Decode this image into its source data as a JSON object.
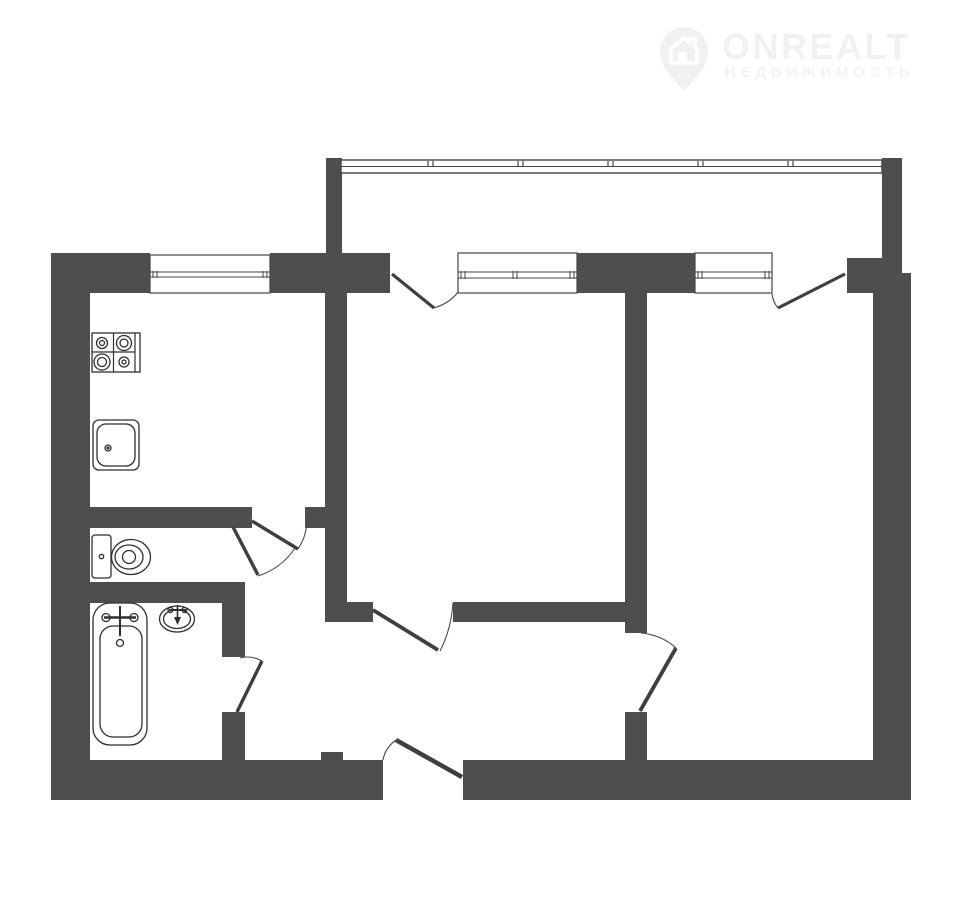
{
  "canvas": {
    "width": 960,
    "height": 910,
    "background": "#ffffff"
  },
  "watermark": {
    "brand": "ONREALT",
    "tagline": "НЕДВИЖИМОСТЬ",
    "color": "#f2f1f1",
    "tagline_color": "#f4f3f3",
    "icon": "house-pin"
  },
  "floorplan": {
    "colors": {
      "wall": "#4e4e4e",
      "outline": "#2f2f2f",
      "frame": "#454545",
      "leaf": "#3f3f3f",
      "arc": "#4a4a4a",
      "floor": "#ffffff"
    },
    "walls": [
      {
        "name": "left-outer",
        "rect": [
          51,
          253,
          39,
          547
        ]
      },
      {
        "name": "bottom-outer-left",
        "rect": [
          51,
          760,
          332,
          40
        ]
      },
      {
        "name": "bottom-outer-right",
        "rect": [
          463,
          760,
          448,
          40
        ]
      },
      {
        "name": "bottom-stub",
        "rect": [
          321,
          752,
          22,
          9
        ]
      },
      {
        "name": "right-outer",
        "rect": [
          873,
          273,
          38,
          527
        ]
      },
      {
        "name": "top-kitchen-left",
        "rect": [
          51,
          253,
          99,
          40
        ]
      },
      {
        "name": "top-kitchen-right",
        "rect": [
          270,
          253,
          120,
          40
        ]
      },
      {
        "name": "top-between-windows",
        "rect": [
          577,
          253,
          118,
          40
        ]
      },
      {
        "name": "top-right",
        "rect": [
          847,
          258,
          55,
          35
        ]
      },
      {
        "name": "balcony-left",
        "rect": [
          326,
          158,
          16,
          95
        ]
      },
      {
        "name": "balcony-right",
        "rect": [
          882,
          158,
          20,
          115
        ]
      },
      {
        "name": "room1-left",
        "rect": [
          325,
          253,
          22,
          369
        ]
      },
      {
        "name": "kitchen-south",
        "rect": [
          51,
          507,
          201,
          21
        ]
      },
      {
        "name": "kitchen-south-piece",
        "rect": [
          305,
          507,
          20,
          21
        ]
      },
      {
        "name": "wc-bath-divider",
        "rect": [
          51,
          582,
          194,
          21
        ]
      },
      {
        "name": "bath-right-upper",
        "rect": [
          222,
          603,
          23,
          54
        ]
      },
      {
        "name": "bath-right-lower",
        "rect": [
          222,
          712,
          23,
          48
        ]
      },
      {
        "name": "hall-room1-left",
        "rect": [
          340,
          602,
          33,
          20
        ]
      },
      {
        "name": "hall-room1-right",
        "rect": [
          453,
          602,
          172,
          20
        ]
      },
      {
        "name": "room2-left-upper",
        "rect": [
          625,
          293,
          22,
          340
        ]
      },
      {
        "name": "room2-left-lower",
        "rect": [
          625,
          712,
          22,
          50
        ]
      }
    ],
    "glazing": {
      "name": "balcony-glazing",
      "x1": 341,
      "x2": 882,
      "top": 160,
      "bottom": 173,
      "mid": 166.5,
      "ticks": [
        428,
        518,
        608,
        698,
        788
      ]
    },
    "windows": [
      {
        "name": "kitchen-window",
        "rect": [
          150,
          255,
          120,
          38
        ],
        "sash_y": [
          272,
          277
        ],
        "ticks": [
          153,
          263
        ]
      },
      {
        "name": "room1-window",
        "rect": [
          458,
          253,
          119,
          40
        ],
        "sash_y": [
          272,
          278
        ],
        "ticks": [
          461,
          513,
          570
        ]
      },
      {
        "name": "room2-window",
        "rect": [
          695,
          253,
          77,
          40
        ],
        "sash_y": [
          272,
          278
        ],
        "ticks": [
          698,
          765
        ]
      }
    ],
    "doors": [
      {
        "name": "balcony-door-room1",
        "leaf": [
          392,
          274,
          434,
          308
        ],
        "leaf_w": 3.2,
        "arc": "M434,308 Q450,303 458,292"
      },
      {
        "name": "balcony-door-room2",
        "leaf": [
          845,
          274,
          778,
          308
        ],
        "leaf_w": 3.2,
        "arc": "M778,308 Q773,302 772,294"
      },
      {
        "name": "kitchen-door",
        "leaf": [
          252,
          521,
          298,
          549
        ],
        "leaf_w": 3.4,
        "arc": "M298,549 Q306,537 307,522"
      },
      {
        "name": "wc-door",
        "leaf": [
          233,
          527,
          258,
          575
        ],
        "leaf_w": 3.4,
        "arc": "M258,576 Q282,568 295,548"
      },
      {
        "name": "bathroom-door",
        "leaf": [
          237,
          712,
          262,
          661
        ],
        "leaf_w": 3.4,
        "arc": "M262,661 Q251,655 240,658"
      },
      {
        "name": "room1-door",
        "leaf": [
          373,
          610,
          438,
          650
        ],
        "leaf_w": 3.8,
        "arc": "M440,651 Q451,630 453,603"
      },
      {
        "name": "room2-door",
        "leaf": [
          640,
          711,
          676,
          648
        ],
        "leaf_w": 3.8,
        "arc": "M676,648 Q662,635 641,633"
      },
      {
        "name": "entrance-door",
        "leaf": [
          462,
          777,
          396,
          740
        ],
        "leaf_w": 4.5,
        "arc": "M396,740 Q385,748 383,760"
      }
    ],
    "fixtures": [
      {
        "name": "stove",
        "rects": [
          [
            92,
            333,
            48,
            39,
            0
          ]
        ],
        "lines": [
          [
            113.5,
            333,
            113.5,
            372,
            1.2
          ],
          [
            135,
            333,
            135,
            372,
            1.2
          ],
          [
            92,
            352,
            135,
            352,
            1.2
          ]
        ],
        "circles": [
          [
            102,
            343,
            5.5
          ],
          [
            102,
            343,
            2.5
          ],
          [
            124,
            343,
            7.5
          ],
          [
            124,
            343,
            4
          ],
          [
            102,
            362,
            8
          ],
          [
            102,
            362,
            4.5
          ],
          [
            124,
            362,
            5
          ],
          [
            124,
            362,
            2
          ]
        ]
      },
      {
        "name": "kitchen-sink",
        "rects": [
          [
            93,
            420,
            46,
            50,
            6
          ],
          [
            97,
            424,
            38,
            42,
            9
          ]
        ],
        "circles": [
          [
            108,
            448,
            3
          ],
          [
            108,
            448,
            0.9,
            "f"
          ]
        ]
      },
      {
        "name": "toilet",
        "rects": [
          [
            92,
            535,
            19,
            43,
            3
          ]
        ],
        "ellipses": [
          [
            131,
            557,
            19.5,
            17.5
          ],
          [
            129,
            557,
            14,
            12
          ]
        ],
        "circles": [
          [
            101.5,
            556.5,
            2.2
          ],
          [
            129,
            557,
            6.5
          ]
        ]
      },
      {
        "name": "bathtub",
        "rects": [
          [
            93,
            603,
            54,
            142,
            17
          ],
          [
            100,
            626,
            42,
            111,
            13
          ]
        ],
        "lines": [
          [
            104,
            617.5,
            136,
            617.5,
            2.4
          ],
          [
            120,
            606,
            120,
            636,
            2
          ]
        ],
        "circles": [
          [
            106,
            617.5,
            4
          ],
          [
            134,
            617.5,
            4
          ],
          [
            120,
            643,
            3.5
          ]
        ]
      },
      {
        "name": "washbasin",
        "ellipses": [
          [
            177,
            619,
            17.5,
            13
          ],
          [
            177,
            619,
            13.5,
            9.5
          ]
        ],
        "lines": [
          [
            169,
            610,
            186,
            610,
            2
          ],
          [
            177.5,
            605,
            177.5,
            618,
            1.6
          ]
        ],
        "circles": [
          [
            170.5,
            610,
            2.5
          ],
          [
            184.5,
            610,
            2.5
          ]
        ],
        "paths": [
          [
            "M174,617 L181,617 L177.5,625 Z"
          ]
        ]
      }
    ]
  }
}
